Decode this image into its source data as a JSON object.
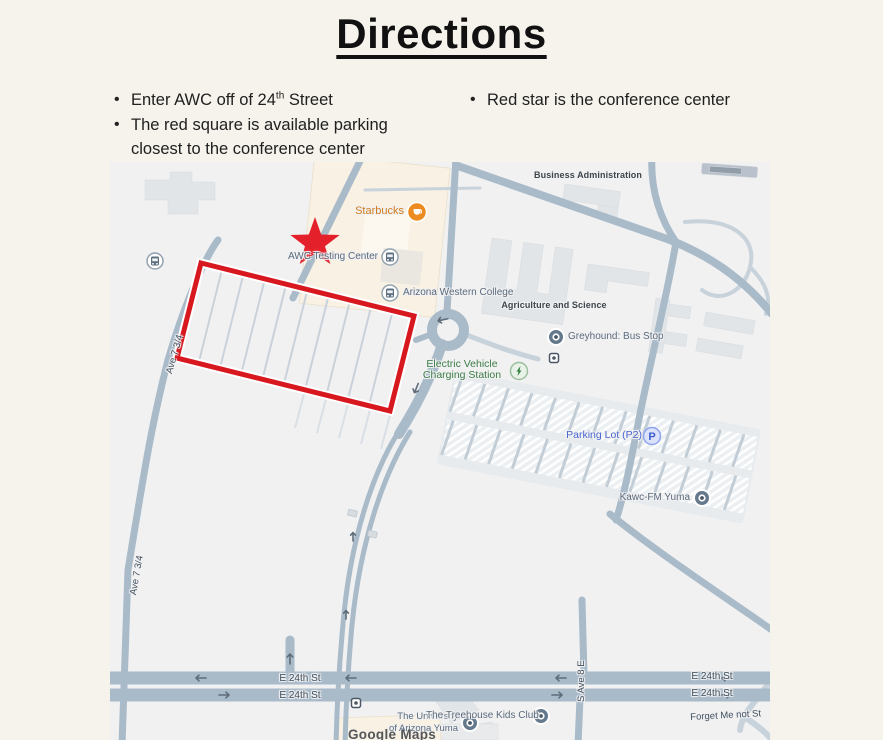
{
  "title": "Directions",
  "bullets": {
    "b1_prefix": "Enter AWC off of 24",
    "b1_sup": "th",
    "b1_suffix": " Street",
    "b2": "The red square is available parking closest to the conference center",
    "b3": "Red star is the conference center"
  },
  "map": {
    "labels": {
      "starbucks": "Starbucks",
      "awc_testing": "AWC Testing Center",
      "awc_college": "Arizona Western College",
      "business_admin": "Business Administration",
      "agriculture": "Agriculture and Science",
      "greyhound": "Greyhound: Bus Stop",
      "ev_line1": "Electric Vehicle",
      "ev_line2": "Charging Station",
      "parking_p2": "Parking Lot (P2)",
      "parking_p2_letter": "P",
      "kawc": "Kawc-FM Yuma",
      "university_line1": "The University",
      "university_line2": "of Arizona Yuma",
      "treehouse": "The Treehouse Kids Club",
      "forget": "Forget Me not St",
      "s_ave_8e": "S Ave 8 E",
      "ave734": "Ave 7 3/4",
      "e24": "E 24th St",
      "watermark": "Google Maps"
    },
    "icons": {
      "bus_stop": "white circle with slate bus glyph",
      "transit_pin": "dark slate circle pin with white ring",
      "ev_charging": "green circle with lightning bolt",
      "parking": "blue circle with letter P",
      "starbucks": "orange circle with white coffee cup",
      "bus_square": "small white square with bus dot",
      "red_star": "red five-point star marking conference center",
      "red_square": "red rectangle outline marking available parking"
    }
  },
  "colors": {
    "accent_red": "#d7191f",
    "star_red": "#e4212b",
    "road": "#a9bac9",
    "road_minor": "#c7d2db",
    "building": "#e2e5e8",
    "poi_building": "#f8f1e4",
    "ev_green": "#3c7d46",
    "poi_orange": "#d07b1d",
    "parking_blue": "#4a66d2",
    "label_gray": "#5b6b7d",
    "page_bg": "#f6f3ec",
    "map_bg": "#f1f1f2"
  }
}
